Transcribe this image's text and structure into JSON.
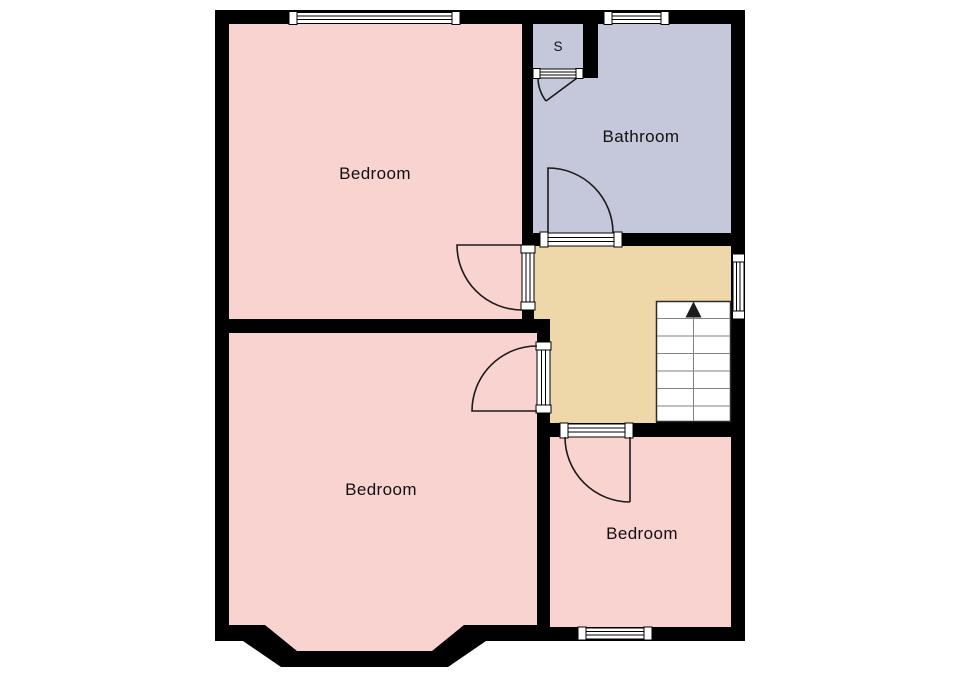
{
  "floorplan": {
    "background_color": "#ffffff",
    "wall_color": "#000000",
    "rooms": {
      "bedroom_front": {
        "label": "Bedroom",
        "color": "#f9d3d0"
      },
      "bedroom_back": {
        "label": "Bedroom",
        "color": "#f9d3d0"
      },
      "bedroom_small": {
        "label": "Bedroom",
        "color": "#f9d3d0"
      },
      "bathroom": {
        "label": "Bathroom",
        "color": "#c5c7db"
      },
      "storage_cupboard": {
        "label": "S",
        "color": "#c5c7db"
      },
      "landing": {
        "label": "",
        "color": "#eed8aa"
      },
      "stairs": {
        "color": "#ffffff",
        "direction_icon": "up-arrow",
        "tread_count": 7
      }
    }
  }
}
